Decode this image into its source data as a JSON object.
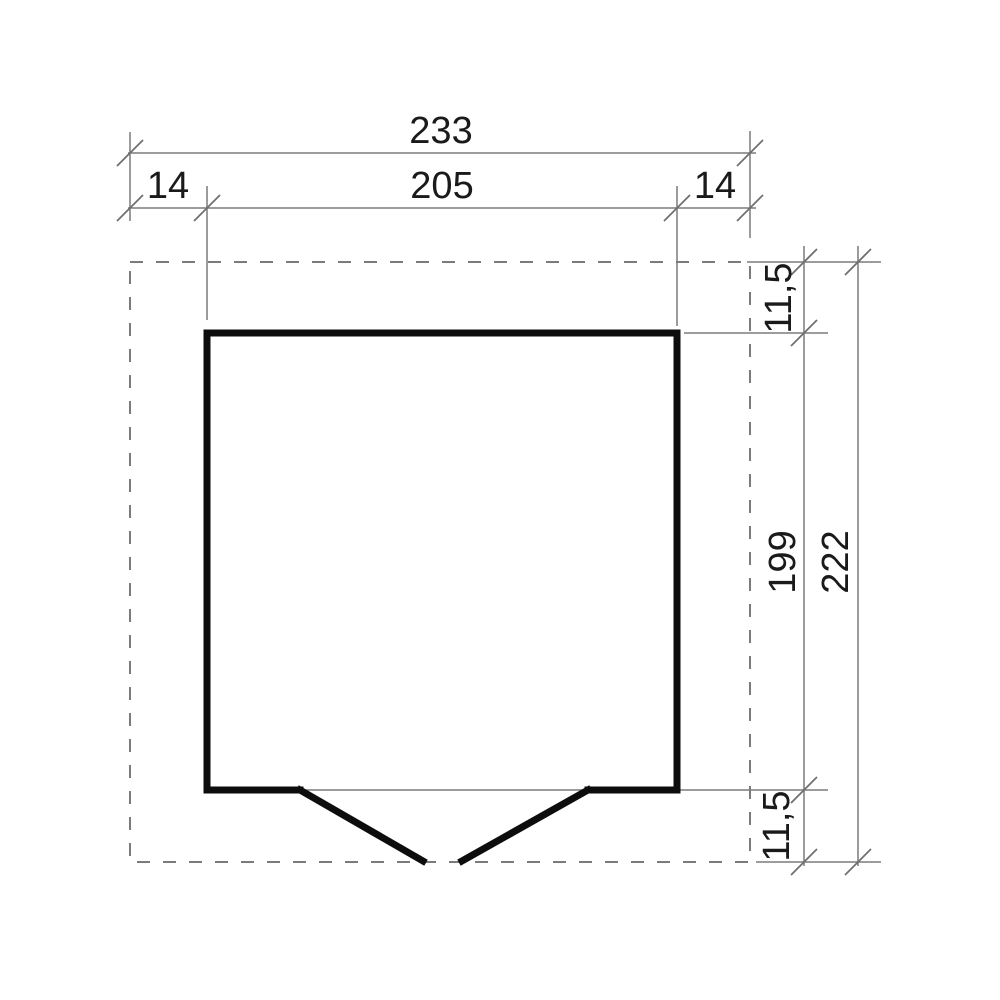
{
  "drawing": {
    "type": "floor-plan-dimension-diagram",
    "dimensions": {
      "top": {
        "total_width": "233",
        "left_overhang": "14",
        "inner_width": "205",
        "right_overhang": "14"
      },
      "right": {
        "top_overhang": "11,5",
        "inner_height": "199",
        "bottom_overhang": "11,5",
        "total_height": "222"
      }
    },
    "colors": {
      "background": "#ffffff",
      "wall": "#0d0d0d",
      "thin_line": "#7b7b7b",
      "tick": "#6f6f6f",
      "dashed_line": "#7b7b7b",
      "text": "#1a1a1a"
    }
  }
}
